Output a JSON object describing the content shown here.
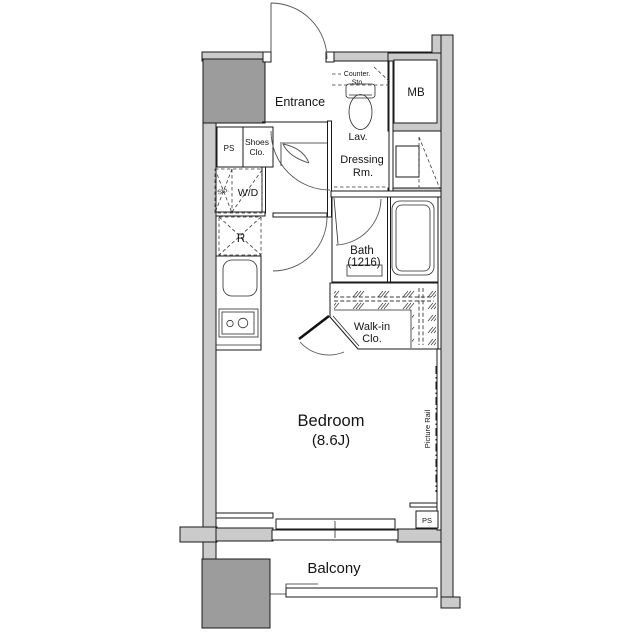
{
  "title": "Studio apartment floor plan",
  "colors": {
    "wall_fill": "#cbcbcb",
    "block_fill": "#9c9c9c",
    "line": "#1a1a1a",
    "background": "#ffffff"
  },
  "rooms": {
    "entrance": {
      "label": "Entrance"
    },
    "meter_box": {
      "label": "MB"
    },
    "pipe_space_upper": {
      "label": "PS"
    },
    "shoes_closet": {
      "label_line1": "Shoes",
      "label_line2": "Clo."
    },
    "storage": {
      "label": "Sto."
    },
    "washer_dryer": {
      "label": "W/D"
    },
    "counter_storage": {
      "label_line1": "Counter.",
      "label_line2": "Sto."
    },
    "lavatory": {
      "label": "Lav."
    },
    "dressing_room": {
      "label_line1": "Dressing",
      "label_line2": "Rm."
    },
    "refrigerator": {
      "label": "R"
    },
    "bath": {
      "label_line1": "Bath",
      "label_line2": "(1216)"
    },
    "walk_in_closet": {
      "label_line1": "Walk-in",
      "label_line2": "Clo."
    },
    "bedroom": {
      "label_line1": "Bedroom",
      "label_line2": "(8.6J)"
    },
    "picture_rail": {
      "label": "Picture Rail"
    },
    "pipe_space_lower": {
      "label": "PS"
    },
    "balcony": {
      "label": "Balcony"
    }
  }
}
